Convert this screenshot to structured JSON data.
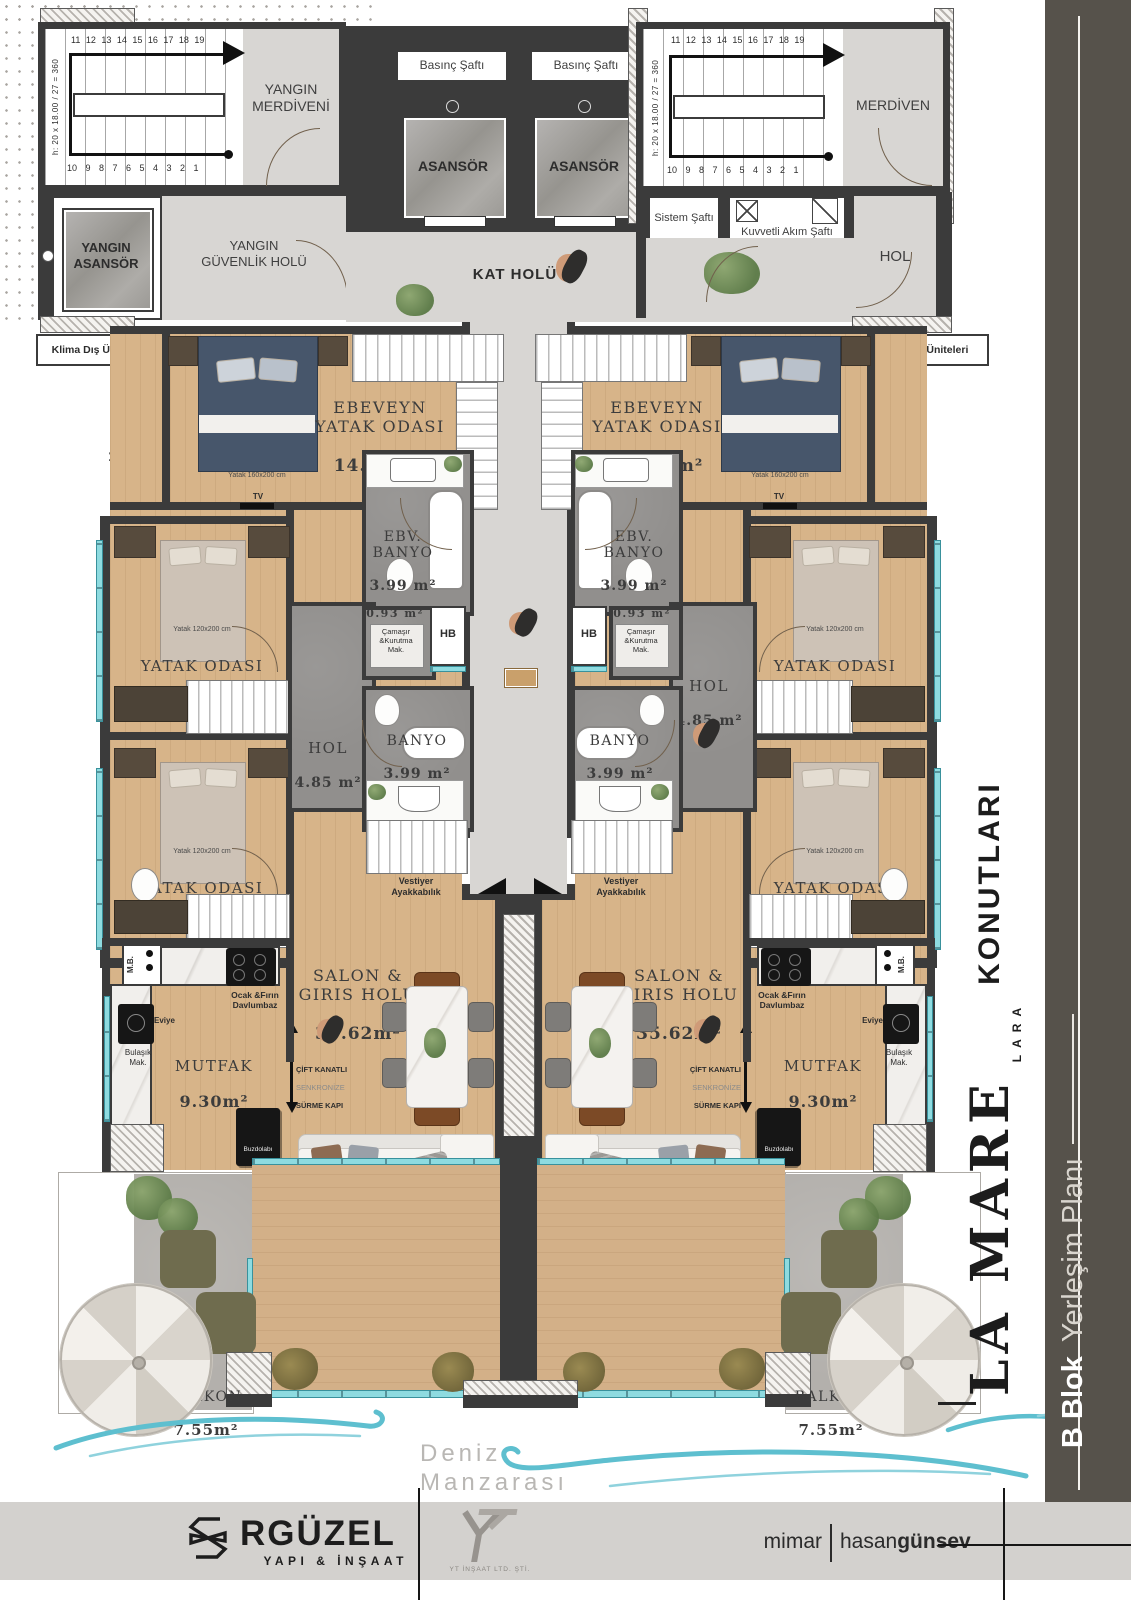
{
  "brand": {
    "name": "LA MARE",
    "sub": "LARA",
    "type": "KONUTLARI",
    "block": "B Blok",
    "plan": "Yerleşim Planı"
  },
  "footer": {
    "builder": "RGÜZEL",
    "builder_sub": "YAPI & İNŞAAT",
    "contractor_sub": "YT İNŞAAT LTD. ŞTİ.",
    "architect_label": "mimar",
    "architect_first": "hasan",
    "architect_last": "günsev"
  },
  "sea": {
    "label": "Deniz Manzarası"
  },
  "core": {
    "fire_stair": "YANGIN\nMERDİVENİ",
    "fire_elevator": "YANGIN\nASANSÖR",
    "fire_lobby": "YANGIN\nGÜVENLİK HOLÜ",
    "pressure_shaft": "Basınç Şaftı",
    "elevator": "ASANSÖR",
    "floor_hall": "KAT HOLÜ",
    "stair": "MERDİVEN",
    "system_shaft": "Sistem Şaftı",
    "power_shaft": "Kuvvetli Akım Şaftı",
    "hall": "HOL",
    "stair_dim": "h: 20 x 18.00 / 27 = 360",
    "stair_numbers_top": "11 12 13 14 15 16 17 18 19",
    "stair_numbers_bottom": "10 9 8 7 6 5 4 3 2 1"
  },
  "exterior": {
    "ac_units": "Klima Dış Üniteleri",
    "sun_breaker": "Güneş\nKırıcı",
    "sun_breaker_area": "2.88 m²"
  },
  "apartment": {
    "master_bedroom": "EBEVEYN\nYATAK ODASI",
    "master_bedroom_area": "14.92 m²",
    "bed_size_160": "Yatak 160x200 cm",
    "bed_size_120": "Yatak 120x200 cm",
    "master_bath": "EBV.\nBANYO",
    "master_bath_area": "3.99 m²",
    "bedroom": "YATAK ODASI",
    "bedroom_1_area": "9.43 m²",
    "bedroom_2_area": "9.84 m²",
    "laundry_area": "0.93 m²",
    "laundry": "Çamaşır\n&Kurutma\nMak.",
    "hose_bib": "HB",
    "hall": "HOL",
    "hall_area": "4.85 m²",
    "bath": "BANYO",
    "bath_area": "3.99 m²",
    "cloakroom": "Vestiyer\nAyakkabılık",
    "living": "SALON &\nGIRIS HOLU",
    "living_area": "35.62m²",
    "kitchen": "MUTFAK",
    "kitchen_area": "9.30m²",
    "sink": "Eviye",
    "dishwasher": "Bulaşık\nMak.",
    "fridge": "Buzdolabı",
    "stove_hood": "Ocak &Fırın\nDavlumbaz",
    "mb": "M.B.",
    "sliding_door_1": "ÇİFT KANATLI",
    "sliding_door_2": "SENKRONİZE",
    "sliding_door_3": "SÜRME KAPI",
    "balcony": "BALKON",
    "balcony_area": "7.55m²",
    "tv": "TV"
  }
}
